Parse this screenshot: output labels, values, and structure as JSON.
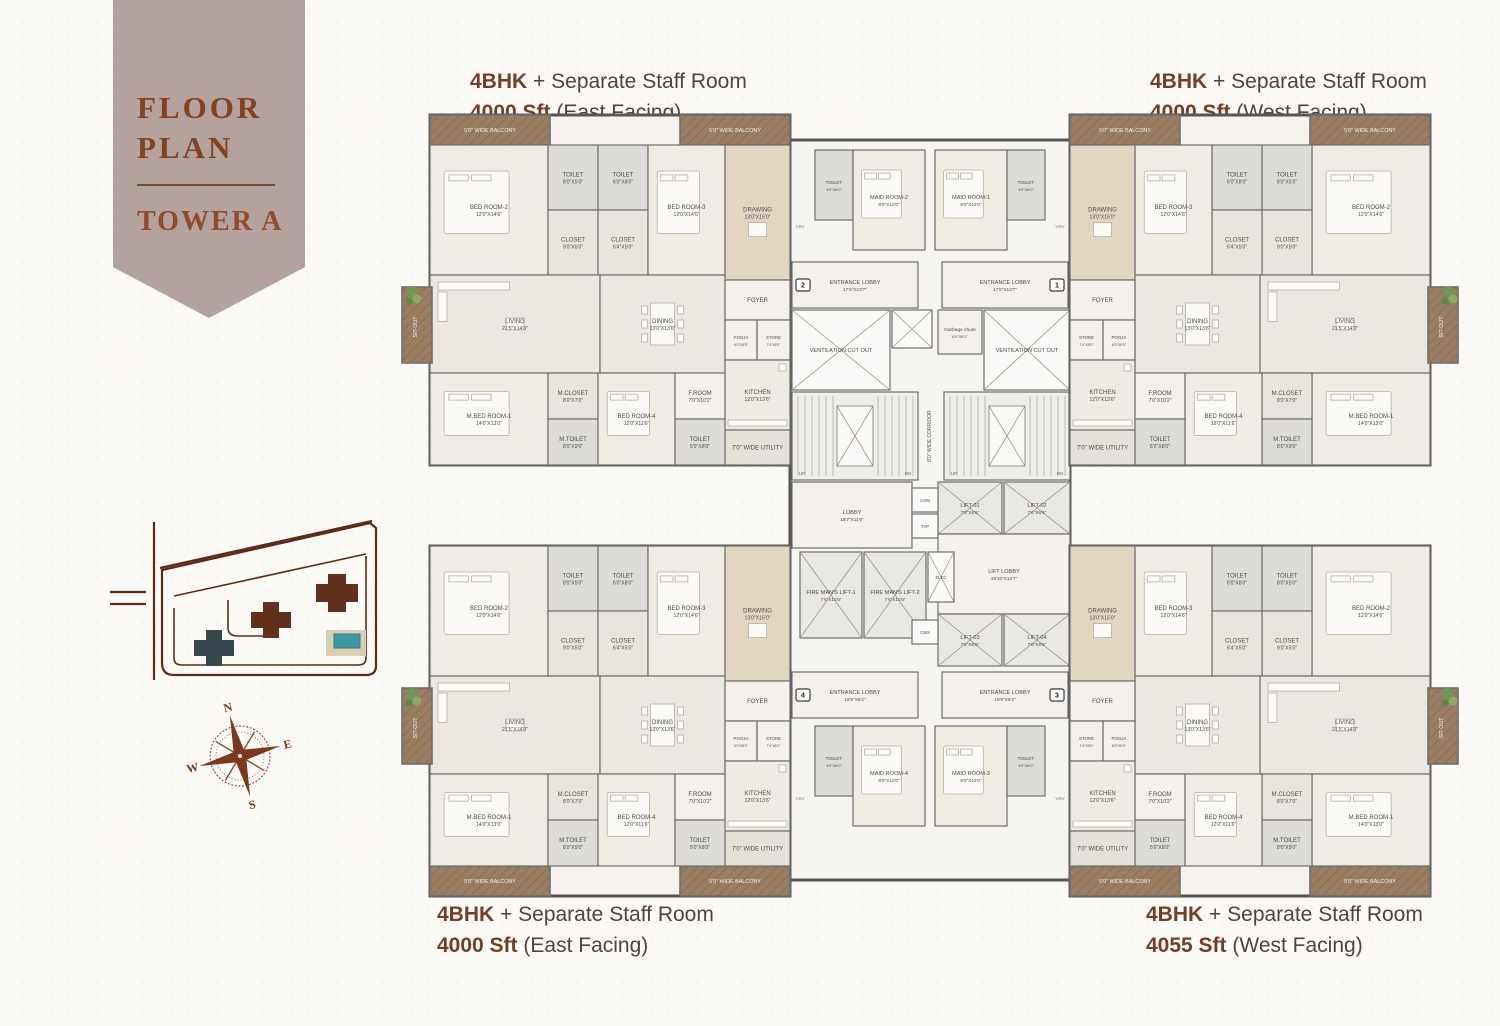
{
  "banner": {
    "line1": "FLOOR",
    "line2": "PLAN",
    "subtitle": "TOWER A"
  },
  "units": [
    {
      "position": "top-left",
      "type": "4BHK",
      "desc": "+ Separate Staff Room",
      "area": "4000 Sft",
      "facing": "(East Facing)"
    },
    {
      "position": "top-right",
      "type": "4BHK",
      "desc": "+ Separate Staff Room",
      "area": "4000 Sft",
      "facing": "(West Facing)"
    },
    {
      "position": "bottom-left",
      "type": "4BHK",
      "desc": "+ Separate Staff Room",
      "area": "4000 Sft",
      "facing": "(East Facing)"
    },
    {
      "position": "bottom-right",
      "type": "4BHK",
      "desc": "+ Separate Staff Room",
      "area": "4055 Sft",
      "facing": "(West Facing)"
    }
  ],
  "compass": {
    "n": "N",
    "e": "E",
    "s": "S",
    "w": "W"
  },
  "colors": {
    "ribbon_bg": "#b3a29e",
    "accent_rust": "#86421f",
    "label_text": "#51423a",
    "wall": "#565656",
    "balcony_wood": "#9a7d62",
    "tower_a_highlight": "#37474f",
    "tower_other": "#63301c",
    "pool_water": "#3c98a3",
    "plant_green": "#6f9654"
  },
  "plan": {
    "corridor_label": "8'0\" WIDE CORRIDOR",
    "vsv_label": "VSV",
    "up_label": "UP",
    "dn_label": "DN",
    "unit_rooms": [
      {
        "id": "balcony-top-a",
        "name": "5'0\" WIDE BALCONY",
        "dims": ""
      },
      {
        "id": "balcony-top-b",
        "name": "5'0\" WIDE BALCONY",
        "dims": ""
      },
      {
        "id": "bed-room-2",
        "name": "BED ROOM-2",
        "dims": "12'0\"X14'6\""
      },
      {
        "id": "toilet-2",
        "name": "TOILET",
        "dims": "8'0\"X5'0\""
      },
      {
        "id": "closet-2",
        "name": "CLOSET",
        "dims": "9'0\"X5'0\""
      },
      {
        "id": "toilet-3",
        "name": "TOILET",
        "dims": "6'0\"X8'0\""
      },
      {
        "id": "closet-3",
        "name": "CLOSET",
        "dims": "6'4\"X5'0\""
      },
      {
        "id": "bed-room-3",
        "name": "BED ROOM-3",
        "dims": "12'0\"X14'6\""
      },
      {
        "id": "drawing",
        "name": "DRAWING",
        "dims": "13'0\"X15'0\""
      },
      {
        "id": "living",
        "name": "LIVING",
        "dims": "21'5\"X14'0\""
      },
      {
        "id": "dining",
        "name": "DINING",
        "dims": "13'0\"X13'6\""
      },
      {
        "id": "foyer",
        "name": "FOYER",
        "dims": ""
      },
      {
        "id": "pooja",
        "name": "POOJA",
        "dims": "6'0\"X5'0\""
      },
      {
        "id": "store",
        "name": "STORE",
        "dims": "7'4\"X5'0\""
      },
      {
        "id": "kitchen",
        "name": "KITCHEN",
        "dims": "12'0\"X13'6\""
      },
      {
        "id": "utility",
        "name": "7'0\" WIDE UTILITY",
        "dims": ""
      },
      {
        "id": "sit-out",
        "name": "SIT-OUT",
        "dims": "8'6\"X7'0\""
      },
      {
        "id": "m-bed-room-1",
        "name": "M.BED ROOM-1",
        "dims": "14'0\"X13'0\""
      },
      {
        "id": "m-closet",
        "name": "M.CLOSET",
        "dims": "8'0\"X7'0\""
      },
      {
        "id": "m-toilet",
        "name": "M.TOILET",
        "dims": "8'0\"X9'0\""
      },
      {
        "id": "bed-room-4",
        "name": "BED ROOM-4",
        "dims": "12'0\"X11'6\""
      },
      {
        "id": "f-room",
        "name": "F.ROOM",
        "dims": "7'0\"X10'2\""
      },
      {
        "id": "toilet-4",
        "name": "TOILET",
        "dims": "5'0\"X8'0\""
      }
    ],
    "core_rooms": [
      {
        "id": "maid-toilet-2",
        "name": "TOILET",
        "dims": "4'0\"X6'0\""
      },
      {
        "id": "maid-room-2",
        "name": "MAID ROOM-2",
        "dims": "8'0\"X12'0\""
      },
      {
        "id": "maid-room-1",
        "name": "MAID ROOM-1",
        "dims": "8'0\"X12'0\""
      },
      {
        "id": "maid-toilet-1",
        "name": "TOILET",
        "dims": "4'0\"X6'0\""
      },
      {
        "id": "entrance-lobby-2",
        "name": "ENTRANCE LOBBY",
        "dims": "17'6\"X13'7\"",
        "badge": "2"
      },
      {
        "id": "entrance-lobby-1",
        "name": "ENTRANCE LOBBY",
        "dims": "17'6\"X13'7\"",
        "badge": "1"
      },
      {
        "id": "vent-l",
        "name": "VENTILATION CUT OUT",
        "dims": ""
      },
      {
        "id": "shaft-a",
        "name": "",
        "dims": ""
      },
      {
        "id": "garbage-chute",
        "name": "Garbage chute",
        "dims": "6'0\"X6'1\""
      },
      {
        "id": "vent-r",
        "name": "VENTILATION CUT OUT",
        "dims": ""
      },
      {
        "id": "stair-l",
        "name": "",
        "dims": ""
      },
      {
        "id": "stair-r",
        "name": "",
        "dims": ""
      },
      {
        "id": "lobby",
        "name": "LOBBY",
        "dims": "18'7\"X11'6\""
      },
      {
        "id": "lift-01",
        "name": "LIFT-01",
        "dims": "7'6\"X6'6\""
      },
      {
        "id": "lift-02",
        "name": "LIFT-02",
        "dims": "7'6\"X6'6\""
      },
      {
        "id": "com-shaft",
        "name": "COM",
        "dims": ""
      },
      {
        "id": "tap-shaft",
        "name": "TAP",
        "dims": ""
      },
      {
        "id": "lift-lobby",
        "name": "LIFT LOBBY",
        "dims": "19'10\"X12'7\""
      },
      {
        "id": "fire-mans-lift-1",
        "name": "FIRE MAN'S LIFT-1",
        "dims": "7'6\"X11'6\""
      },
      {
        "id": "fire-mans-lift-2",
        "name": "FIRE MAN'S LIFT-2",
        "dims": "7'6\"X11'6\""
      },
      {
        "id": "elec-shaft",
        "name": "ELEC",
        "dims": ""
      },
      {
        "id": "lift-03",
        "name": "LIFT-03",
        "dims": "7'6\"X6'6\""
      },
      {
        "id": "lift-04",
        "name": "LIFT-04",
        "dims": "7'6\"X6'6\""
      },
      {
        "id": "cws-shaft",
        "name": "CWS",
        "dims": ""
      },
      {
        "id": "entrance-lobby-4",
        "name": "ENTRANCE LOBBY",
        "dims": "19'6\"X9'2\"",
        "badge": "4"
      },
      {
        "id": "entrance-lobby-3",
        "name": "ENTRANCE LOBBY",
        "dims": "19'6\"X9'2\"",
        "badge": "3"
      },
      {
        "id": "maid-toilet-4",
        "name": "TOILET",
        "dims": "4'0\"X6'0\""
      },
      {
        "id": "maid-room-4",
        "name": "MAID ROOM-4",
        "dims": "8'0\"X12'0\""
      },
      {
        "id": "maid-room-3",
        "name": "MAID ROOM-3",
        "dims": "8'0\"X12'0\""
      },
      {
        "id": "maid-toilet-3",
        "name": "TOILET",
        "dims": "4'0\"X6'0\""
      }
    ]
  }
}
